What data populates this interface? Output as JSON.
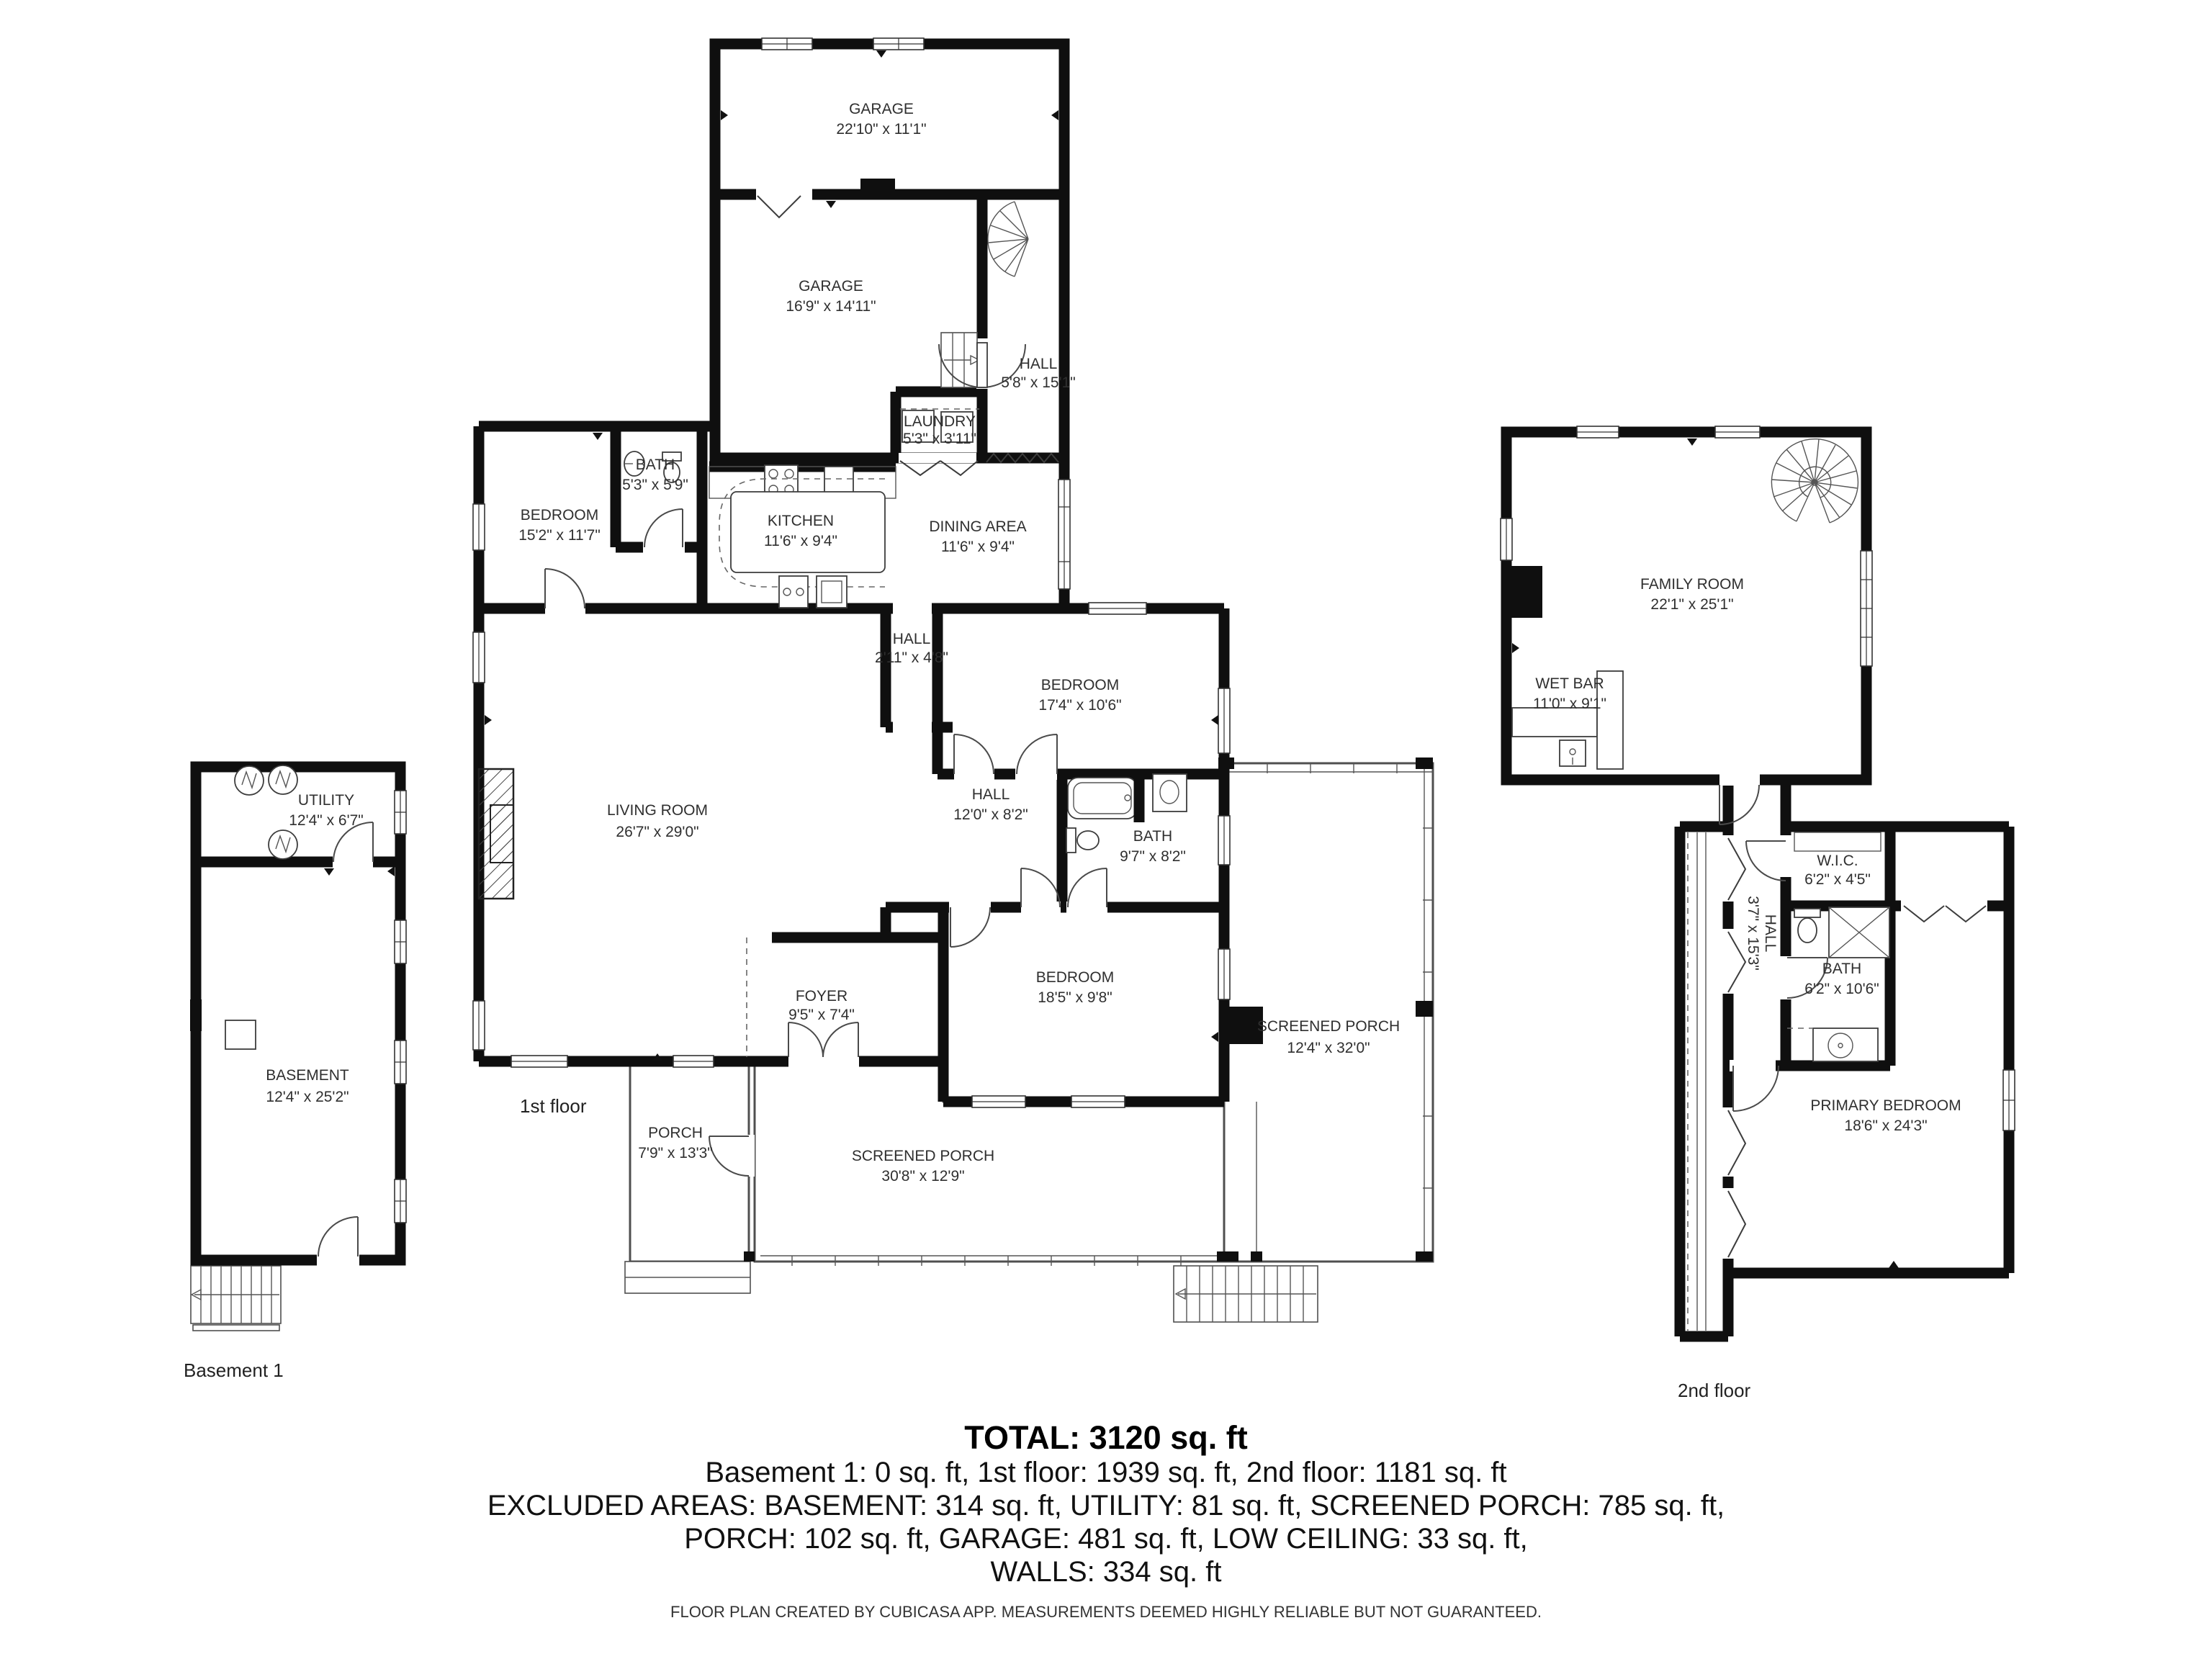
{
  "captions": {
    "basement": "Basement 1",
    "first_floor": "1st floor",
    "second_floor": "2nd floor"
  },
  "rooms": {
    "utility": {
      "name": "UTILITY",
      "dims": "12'4\" x 6'7\""
    },
    "basement": {
      "name": "BASEMENT",
      "dims": "12'4\" x 25'2\""
    },
    "garage1": {
      "name": "GARAGE",
      "dims": "22'10\" x 11'1\""
    },
    "garage2": {
      "name": "GARAGE",
      "dims": "16'9\" x 14'11\""
    },
    "hall_upper": {
      "name": "HALL",
      "dims": "5'8\" x 15'1\""
    },
    "laundry": {
      "name": "LAUNDRY",
      "dims": "5'3\" x 3'11\""
    },
    "bath_small": {
      "name": "BATH",
      "dims": "5'3\" x 5'9\""
    },
    "bedroom_15": {
      "name": "BEDROOM",
      "dims": "15'2\" x 11'7\""
    },
    "kitchen": {
      "name": "KITCHEN",
      "dims": "11'6\" x 9'4\""
    },
    "dining": {
      "name": "DINING AREA",
      "dims": "11'6\" x 9'4\""
    },
    "hall_small": {
      "name": "HALL",
      "dims": "2'11\" x 4'8\""
    },
    "bedroom_17": {
      "name": "BEDROOM",
      "dims": "17'4\" x 10'6\""
    },
    "living": {
      "name": "LIVING ROOM",
      "dims": "26'7\" x 29'0\""
    },
    "hall_12": {
      "name": "HALL",
      "dims": "12'0\" x 8'2\""
    },
    "bath_97": {
      "name": "BATH",
      "dims": "9'7\" x 8'2\""
    },
    "bedroom_18": {
      "name": "BEDROOM",
      "dims": "18'5\" x 9'8\""
    },
    "foyer": {
      "name": "FOYER",
      "dims": "9'5\" x 7'4\""
    },
    "porch": {
      "name": "PORCH",
      "dims": "7'9\" x 13'3\""
    },
    "screened_south": {
      "name": "SCREENED PORCH",
      "dims": "30'8\" x 12'9\""
    },
    "screened_east": {
      "name": "SCREENED PORCH",
      "dims": "12'4\" x 32'0\""
    },
    "family": {
      "name": "FAMILY ROOM",
      "dims": "22'1\" x 25'1\""
    },
    "wet_bar": {
      "name": "WET BAR",
      "dims": "11'0\" x 9'1\""
    },
    "wic": {
      "name": "W.I.C.",
      "dims": "6'2\" x 4'5\""
    },
    "hall_2nd": {
      "name": "HALL",
      "dims": "3'7\" x 15'3\""
    },
    "bath_2nd": {
      "name": "BATH",
      "dims": "6'2\" x 10'6\""
    },
    "primary": {
      "name": "PRIMARY BEDROOM",
      "dims": "18'6\" x 24'3\""
    }
  },
  "summary": {
    "total": "TOTAL: 3120 sq. ft",
    "line2": "Basement 1: 0 sq. ft, 1st floor: 1939 sq. ft, 2nd floor: 1181 sq. ft",
    "line3": "EXCLUDED AREAS: BASEMENT: 314 sq. ft, UTILITY: 81 sq. ft, SCREENED PORCH: 785 sq. ft,",
    "line4": "PORCH: 102 sq. ft, GARAGE: 481 sq. ft, LOW CEILING: 33 sq. ft,",
    "line5": "WALLS: 334 sq. ft"
  },
  "footer": "FLOOR PLAN CREATED BY CUBICASA APP. MEASUREMENTS DEEMED HIGHLY RELIABLE BUT NOT GUARANTEED."
}
